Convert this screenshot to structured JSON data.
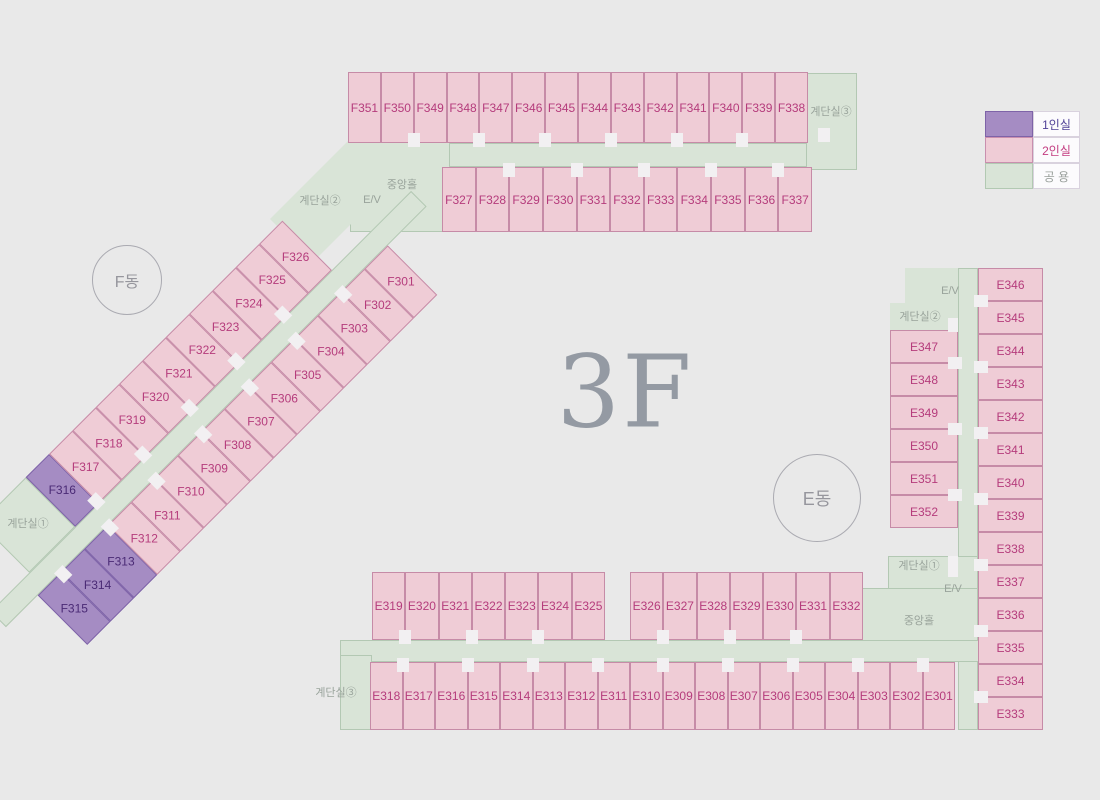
{
  "floor_label": "3F",
  "badges": {
    "f": "F동",
    "e": "E동"
  },
  "legend": {
    "items": [
      {
        "label": "1인실",
        "type": "single"
      },
      {
        "label": "2인실",
        "type": "double"
      },
      {
        "label": "공 용",
        "type": "common"
      }
    ]
  },
  "halls": {
    "f_jungang": "중앙홀",
    "f_ev": "E/V",
    "f_stair2": "계단실②",
    "f_stair3": "계단실③",
    "f_stair1": "계단실①",
    "e_ev_top": "E/V",
    "e_stair2": "계단실②",
    "e_stair1": "계단실①",
    "e_ev_bottom": "E/V",
    "e_jungang": "중앙홀",
    "e_stair3": "계단실③"
  },
  "rooms": {
    "f_top_row1": [
      "F351",
      "F350",
      "F349",
      "F348",
      "F347",
      "F346",
      "F345",
      "F344",
      "F343",
      "F342",
      "F341",
      "F340",
      "F339",
      "F338"
    ],
    "f_top_row2": [
      "F327",
      "F328",
      "F329",
      "F330",
      "F331",
      "F332",
      "F333",
      "F334",
      "F335",
      "F336",
      "F337"
    ],
    "f_diag_outer": [
      "F316",
      "F317",
      "F318",
      "F319",
      "F320",
      "F321",
      "F322",
      "F323",
      "F324",
      "F325",
      "F326"
    ],
    "f_diag_inner": [
      "F315",
      "F314",
      "F313",
      "F312",
      "F311",
      "F310",
      "F309",
      "F308",
      "F307",
      "F306",
      "F305",
      "F304",
      "F303",
      "F302",
      "F301"
    ],
    "e_col_left": [
      "E347",
      "E348",
      "E349",
      "E350",
      "E351",
      "E352"
    ],
    "e_col_right": [
      "E346",
      "E345",
      "E344",
      "E343",
      "E342",
      "E341",
      "E340",
      "E339",
      "E338",
      "E337",
      "E336",
      "E335",
      "E334",
      "E333"
    ],
    "bottom_upper1": [
      "E319",
      "E320",
      "E321",
      "E322",
      "E323",
      "E324",
      "E325"
    ],
    "bottom_upper2": [
      "E326",
      "E327",
      "E328",
      "E329",
      "E330",
      "E331",
      "E332"
    ],
    "bottom_lower": [
      "E318",
      "E317",
      "E316",
      "E315",
      "E314",
      "E313",
      "E312",
      "E311",
      "E310",
      "E309",
      "E308",
      "E307",
      "E306",
      "E305",
      "E304",
      "E303",
      "E302",
      "E301"
    ]
  },
  "single_rooms": [
    "F313",
    "F314",
    "F315",
    "F316"
  ],
  "colors": {
    "single_fill": "#a58cc3",
    "single_border": "#7e63a8",
    "double_fill": "#efccd6",
    "double_border": "#c68ba7",
    "common_fill": "#d9e4d7",
    "common_border": "#b3c8b3",
    "accent_text": "#b53c7c"
  }
}
